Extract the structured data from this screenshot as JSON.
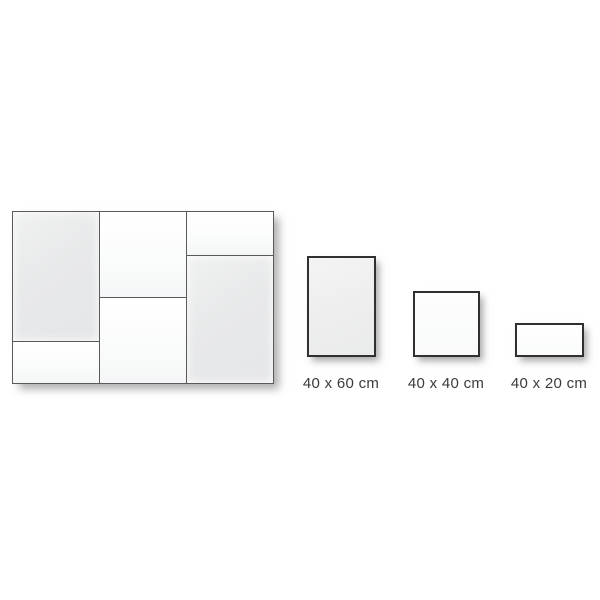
{
  "page": {
    "background_color": "#ffffff",
    "description_label": "tile size layout diagram"
  },
  "composite_layout": {
    "cells": [
      {
        "position": "left-top",
        "shape": "tall-portrait",
        "fill": "gray"
      },
      {
        "position": "left-bottom",
        "shape": "short-strip",
        "fill": "white"
      },
      {
        "position": "middle-top",
        "shape": "square",
        "fill": "white"
      },
      {
        "position": "middle-bottom",
        "shape": "square",
        "fill": "white"
      },
      {
        "position": "right-top",
        "shape": "short-strip",
        "fill": "white"
      },
      {
        "position": "right-bottom",
        "shape": "tall-portrait",
        "fill": "gray"
      }
    ],
    "grid_line_color": "#5a5a5a"
  },
  "sizes": [
    {
      "label": "40 x 60 cm",
      "width_cm": 40,
      "height_cm": 60,
      "orientation": "portrait"
    },
    {
      "label": "40 x 40 cm",
      "width_cm": 40,
      "height_cm": 40,
      "orientation": "square"
    },
    {
      "label": "40 x 20 cm",
      "width_cm": 40,
      "height_cm": 20,
      "orientation": "landscape"
    }
  ],
  "colors": {
    "swatch_border": "#303030",
    "cell_gray": "#e8e9ea",
    "cell_white": "#fbfcfc",
    "label_text": "#3b3b3b",
    "shadow": "rgba(110,110,110,0.6)"
  }
}
